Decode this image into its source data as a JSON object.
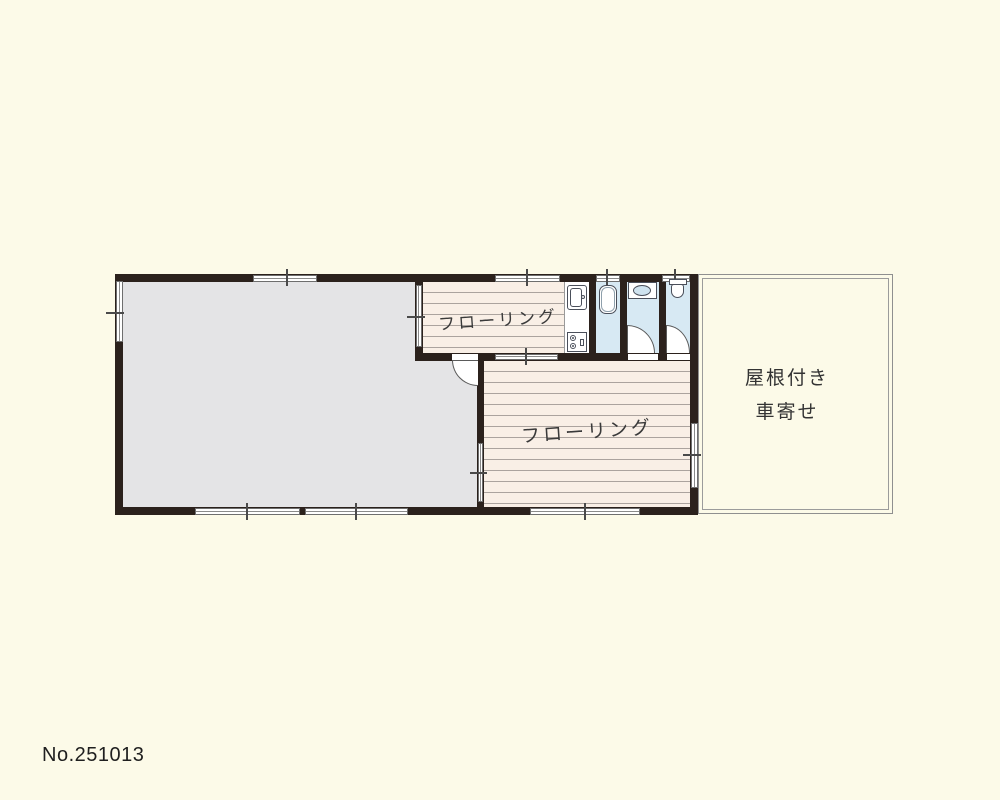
{
  "plan_number": "No.251013",
  "floor_plan": {
    "rooms": {
      "flooring_upper": {
        "label": "フローリング"
      },
      "flooring_lower": {
        "label": "フローリング"
      },
      "carport": {
        "label_line1": "屋根付き",
        "label_line2": "車寄せ"
      }
    },
    "fixtures": {
      "kitchen_sink": "kitchen-sink",
      "stove": "gas-stove",
      "bathtub": "bathtub",
      "washbasin": "washbasin",
      "toilet": "toilet"
    },
    "colors": {
      "page_background": "#FCFAE8",
      "wall": "#2B211C",
      "concrete_room": "#E4E4E6",
      "flooring": "#F9EFE6",
      "plank_line": "#ABA39E",
      "wet_area": "#D7E9F3",
      "window": "#FFFFFF",
      "carport_border": "#8F8F8F",
      "text": "#3A3A3A"
    }
  }
}
